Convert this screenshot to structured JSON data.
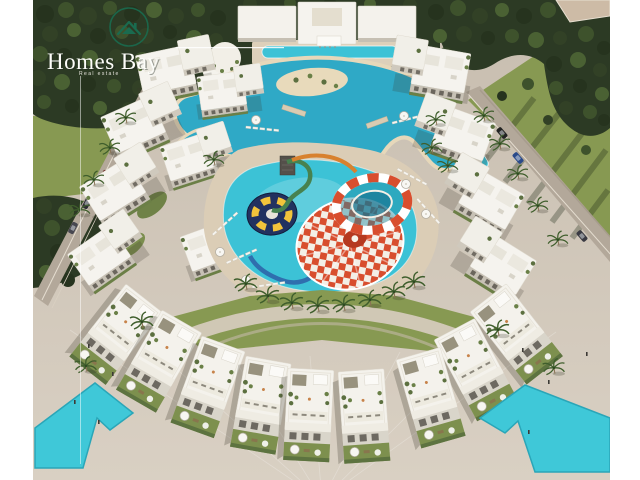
{
  "page": {
    "background": "#ffffff",
    "kind": "aerial-3d-render-of-resort-masterplan"
  },
  "logo": {
    "title": "Homes Bay",
    "tagline": "Real estate",
    "emblem_icon": "house-in-circle-icon",
    "emblem_color": "#1a6b4f",
    "title_color": "#fdfdfa"
  },
  "palette": {
    "trees_dark": "#26331e",
    "trees_mid": "#324126",
    "trees_light": "#3e522c",
    "lawn": "#879952",
    "lawn_shadow": "#5f7340",
    "pavement": "#cdc3b5",
    "pavement_light": "#d8cfc2",
    "road": "#b3a89a",
    "sand": "#e4d6b8",
    "deck_sand": "#dbcdb6",
    "lagoon_water": "#2fa9c6",
    "pool_water": "#3cc2d6",
    "feature_water": "#3fc8d8",
    "building_white": "#f5f3ee",
    "building_shade": "#c9c3b7",
    "slide_red": "#d84e2e",
    "slide_yellow": "#f2c43b",
    "slide_navy": "#223260",
    "slide_green": "#47824f",
    "slide_blue": "#2f6fae",
    "slide_orange": "#d8812e"
  },
  "scene": {
    "features": [
      "clubhouse",
      "swim-lagoon",
      "aqua-park-pool",
      "spiral-funnel-slide",
      "bowl-slide",
      "slide-tower",
      "apartment-ring",
      "townhouse-rows",
      "palm-lined-roads",
      "beach-plaza",
      "water-features"
    ]
  }
}
